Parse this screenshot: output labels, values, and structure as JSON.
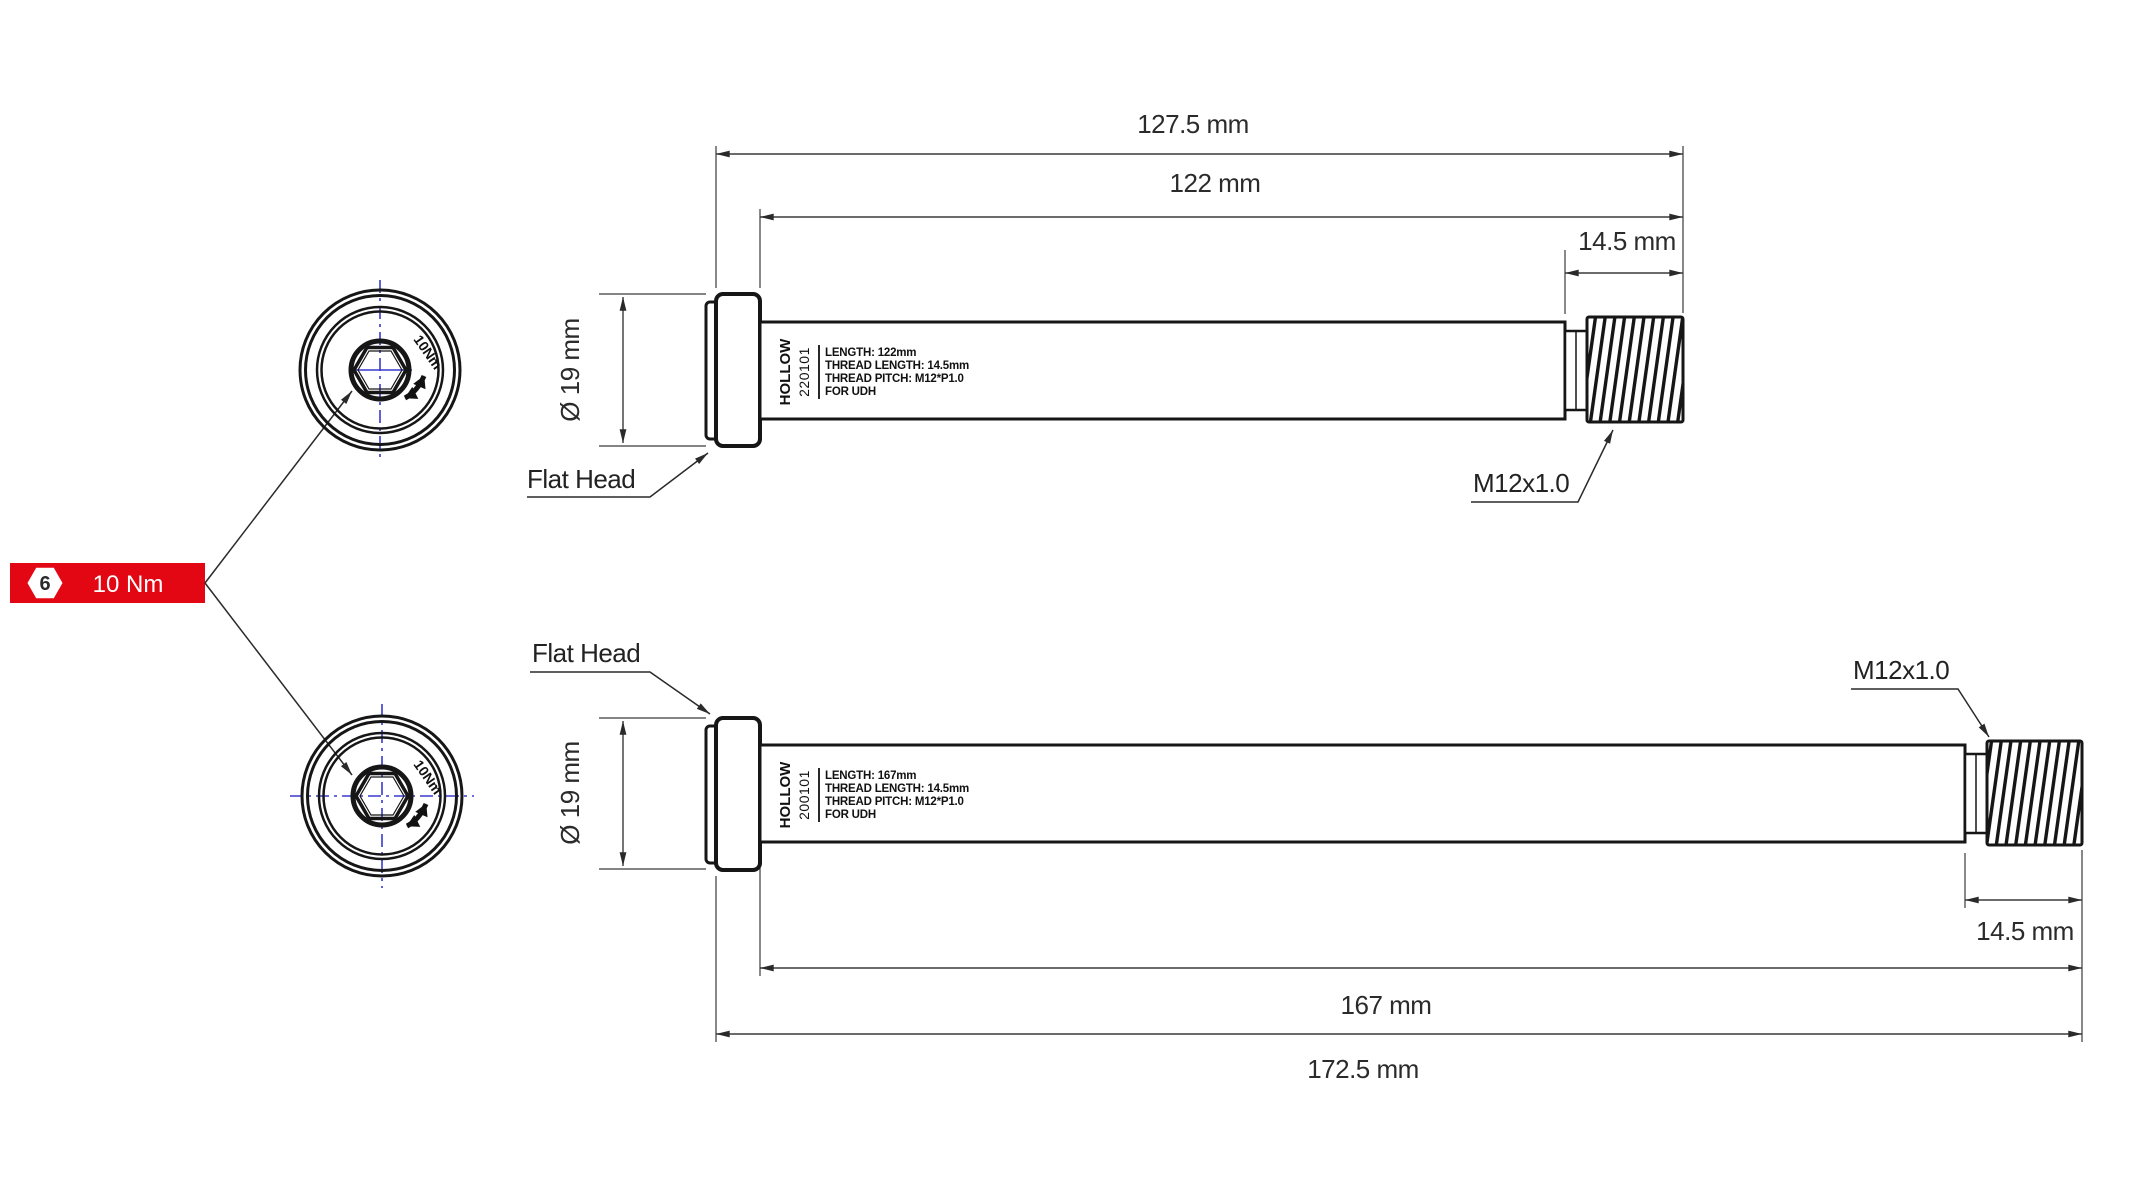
{
  "colors": {
    "ink": "#161616",
    "dim": "#3a3a3a",
    "accent_red": "#e30613",
    "centerline_blue": "#3939cf"
  },
  "torque_badge": {
    "tool_size": "6",
    "torque": "10 Nm"
  },
  "end_views": {
    "top_torque_note": "10Nm",
    "bottom_torque_note": "10Nm"
  },
  "axles": [
    {
      "flat_head_label": "Flat Head",
      "thread_label": "M12x1.0",
      "dim_overall": "127.5 mm",
      "dim_length": "122 mm",
      "dim_thread": "14.5 mm",
      "dim_head_diameter": "Ø 19 mm",
      "brand": "HOLLOW",
      "model": "220101",
      "spec_lines": [
        "LENGTH: 122mm",
        "THREAD LENGTH: 14.5mm",
        "THREAD PITCH: M12*P1.0",
        "FOR UDH"
      ]
    },
    {
      "flat_head_label": "Flat Head",
      "thread_label": "M12x1.0",
      "dim_overall": "172.5 mm",
      "dim_length": "167 mm",
      "dim_thread": "14.5 mm",
      "dim_head_diameter": "Ø 19 mm",
      "brand": "HOLLOW",
      "model": "200101",
      "spec_lines": [
        "LENGTH: 167mm",
        "THREAD LENGTH: 14.5mm",
        "THREAD PITCH: M12*P1.0",
        "FOR UDH"
      ]
    }
  ]
}
